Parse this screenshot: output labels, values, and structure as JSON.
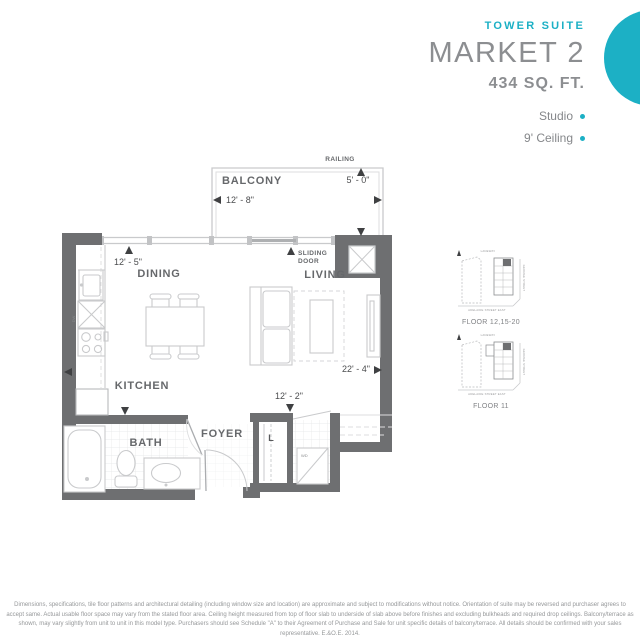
{
  "header": {
    "collection_label": "TOWER SUITE",
    "suite_name": "MARKET 2",
    "suite_area": "434 SQ. FT.",
    "features": [
      {
        "label": "Studio"
      },
      {
        "label": "9' Ceiling"
      }
    ]
  },
  "colors": {
    "accent_teal": "#1cb0c5",
    "wall_gray": "#6e6f71",
    "fixture_gray": "#c9cacc",
    "label_gray": "#66686b"
  },
  "floorplan": {
    "room_labels": {
      "balcony": "BALCONY",
      "dining": "DINING",
      "living": "LIVING",
      "kitchen": "KITCHEN",
      "bath": "BATH",
      "foyer": "FOYER"
    },
    "fixture_labels": {
      "railing": "RAILING",
      "sliding_door_line1": "SLIDING",
      "sliding_door_line2": "DOOR",
      "linen_closet": "L",
      "washer_dryer": "WD",
      "dishwasher": "DW"
    },
    "dimensions": {
      "balcony_width": "12' - 8\"",
      "balcony_depth": "5' - 0\"",
      "suite_width": "12' - 5\"",
      "suite_length": "22' - 4\"",
      "entry_width": "12' - 2\""
    }
  },
  "keyplans": [
    {
      "caption": "FLOOR 12,15-20",
      "streets": {
        "top": "LANEWAY",
        "right": "GEORGE STREET",
        "bottom": "ADELAIDE STREET EAST"
      }
    },
    {
      "caption": "FLOOR 11",
      "streets": {
        "top": "LANEWAY",
        "right": "GEORGE STREET",
        "bottom": "ADELAIDE STREET EAST"
      }
    }
  ],
  "disclaimer": "Dimensions, specifications, tile floor patterns and architectural detailing (including window size and location) are approximate and subject to modifications without notice. Orientation of suite may be reversed and purchaser agrees to accept same. Actual usable floor space may vary from the stated floor area. Ceiling height measured from top of floor slab to underside of slab above before finishes and excluding bulkheads and required drop ceilings. Balcony/terrace as shown, may vary slightly from unit to unit in this model type. Purchasers should see Schedule \"A\" to their Agreement of Purchase and Sale for unit specific details of balcony/terrace. All details should be confirmed with your sales representative. E.&O.E. 2014."
}
